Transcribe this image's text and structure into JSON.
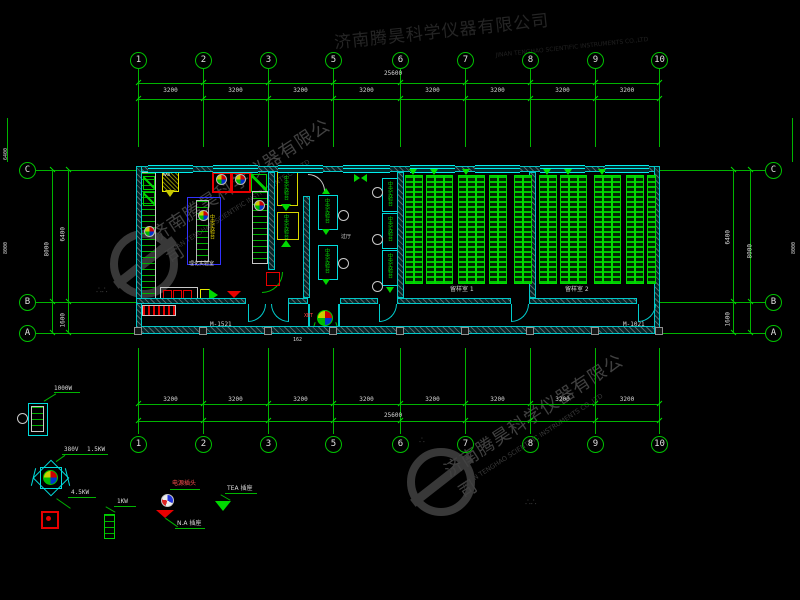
{
  "watermark": {
    "cn": "济南腾昊科学仪器有限公司",
    "en": "JINAN TENGHAO SCIENTIFIC INSTRUMENTS CO.,LTD"
  },
  "grid": {
    "cols": [
      "1",
      "2",
      "3",
      "5",
      "6",
      "7",
      "8",
      "9",
      "10"
    ],
    "rows": [
      "C",
      "B",
      "A"
    ],
    "seg": "3200",
    "total": "25600",
    "side": {
      "seg_main": "6400",
      "seg_small": "1600",
      "total": "8000"
    }
  },
  "plan": {
    "door_left": "M-1521",
    "door_right": "M-1021",
    "entry_dim": "162",
    "room_lab": "理化实验室",
    "room_hall": "过厅",
    "room_sample1": "留样室 1",
    "room_sample2": "留样室 2",
    "bench_central": "中央实验台",
    "fan_tag": "XBT",
    "cab_tag": "MAX"
  },
  "legend": {
    "fan_w": "1000W",
    "volt": "380V",
    "kw1": "1.5KW",
    "kw2": "4.5KW",
    "kw3": "1KW",
    "plug_title": "电源插头",
    "plug_na": "N.A 插座",
    "plug_tea": "TEA 插座"
  }
}
